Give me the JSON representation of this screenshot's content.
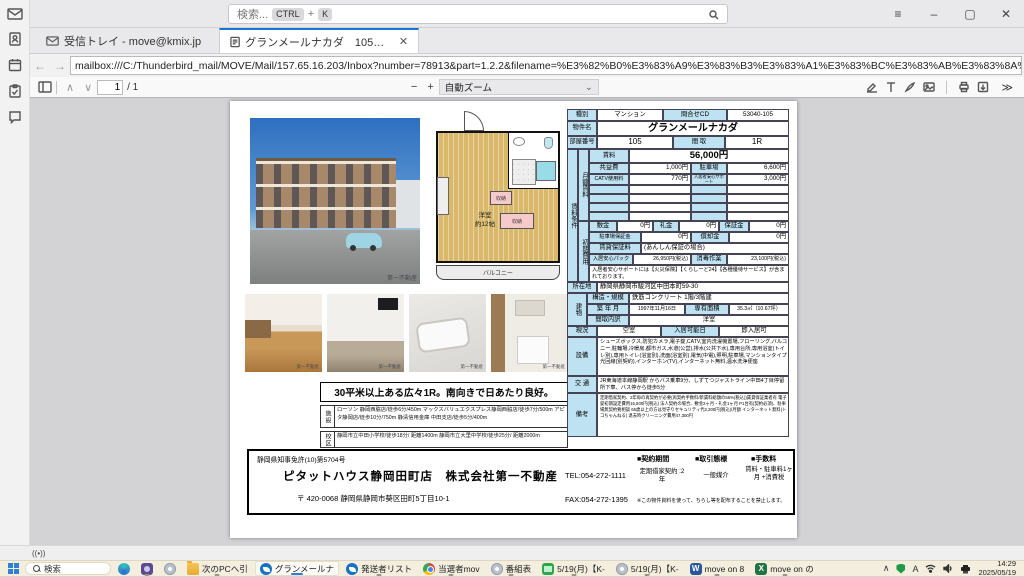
{
  "colors": {
    "accent_blue": "#1a73d1",
    "table_label_blue": "#bfe2f2",
    "taskbar_bg": "#f3eedd"
  },
  "titlebar": {
    "search_placeholder": "検索...",
    "key_ctrl": "CTRL",
    "key_plus": "+",
    "key_k": "K"
  },
  "window_controls": {
    "menu": "≡",
    "minimize": "–",
    "maximize": "▢",
    "close": "✕"
  },
  "tabs": {
    "inbox": "受信トレイ - move@kmix.jp",
    "pdf": "グランメールナカダ　105号室.p",
    "pdf_close": "✕"
  },
  "urlbar": {
    "back": "←",
    "forward": "→",
    "url": "mailbox:///C:/Thunderbird_mail/MOVE/Mail/157.65.16.203/Inbox?number=78913&part=1.2.2&filename=%E3%82%B0%E3%83%A9%E3%83%B3%E3%83%A1%E3%83%BC%E3%83%AB%E3%83%8A%E3%82%AB%E3%83%80%E3%80%80105%E"
  },
  "pdfbar": {
    "up": "∧",
    "down": "∨",
    "page": "1",
    "total": "/ 1",
    "minus": "−",
    "plus": "+",
    "zoom": "自動ズーム",
    "zoom_caret": "⌄",
    "more": "≫"
  },
  "statusbar": {
    "broadcast": "((•))"
  },
  "doc": {
    "spec": {
      "type_label": "種別",
      "type": "マンション",
      "code_label": "問合せCD",
      "code": "53040-105",
      "name_label": "物件名",
      "name": "グランメールナカダ",
      "room_label": "部屋番号",
      "room": "105",
      "layout_label": "間 取",
      "layout": "1R"
    },
    "terms_label": "賃料条件",
    "monthly_label": "月額賃料",
    "monthly": {
      "rent_label": "賃料",
      "rent": "56,000円",
      "fee_label": "共益費",
      "fee": "1,000円",
      "parking_label": "駐車場",
      "parking": "6,600円",
      "catv_label": "CATV使用料",
      "catv": "770円",
      "support_label": "入居者安心サポート",
      "support": "3,000円"
    },
    "initial_label": "初期費用",
    "initial": {
      "shikikin_label": "敷金",
      "shikikin": "0円",
      "reikin_label": "礼金",
      "reikin": "0円",
      "hoshokin_label": "保証金",
      "hoshokin": "0円",
      "parking_dep_label": "駐車場保証金",
      "parking_dep": "0円",
      "shokyaku_label": "償却金",
      "shokyaku": "0円",
      "guarantee_label": "賃貸保証料",
      "guarantee": "(あんしん保証の場合)",
      "anshin_label": "入居安心パック",
      "anshin": "26,950円(税込)",
      "disinfect_label": "消毒作業",
      "disinfect": "23,100円(税込)",
      "note": "入居者安心サポートには【火災保険】【くらしーど24】【各種優待サービス】が含まれております。"
    },
    "location_label": "所在地",
    "location": "静岡県静岡市駿河区中田本町59-30",
    "building_label": "建物",
    "building": {
      "structure_label": "構造・規模",
      "structure": "鉄筋コンクリート 1階/3階建",
      "built_label": "築 年 月",
      "built": "1997年11月16日",
      "area_label": "専有面積",
      "area": "35.3㎡（10.67坪）",
      "layout_detail_label": "間取内訳",
      "layout_detail": "洋室"
    },
    "status_label": "現況",
    "status": "空室",
    "movein_label": "入居可能日",
    "movein": "即入居可",
    "equipment_label": "設備",
    "equipment": "シューズボックス,防犯カメラ,電子錠,CATV,室内洗濯機置場,フローリング,バルコニー,駐輪場,冷暖房,都市ガス,水道(公営),排水(公共下水),専用台所,専用浴室(トイレ別),専用トイレ(浴室別),洗面(浴室別),電気(中電),照明,駐車場,マンションタイプ光回線(別契約),インターホン(TV),インターネット無料,温水洗浄便座",
    "access_label": "交 通",
    "access": "JR東海道本線静岡駅 からバス乗車9分、しずてつジャストライン中田4丁目停留所下車、バス停から徒歩5分",
    "remarks_label": "備考",
    "remarks": "定期借家契約、2年毎の再契約が必要(再契約手数料/新賃料総額の55%(税込))賃貸保証業者有 電子錠初期設定費用16,500円(税込) 法人契約の場合、敷金2ヶ月・礼金1ヶ月 P1台有(契約必須)、駐車場無契約要相談 65歳以上の方は見守りセキュリティ代2,200円(税込)/月額 インターネット無料(トコちゃんねる) 退去時クリーニング費用47,300円",
    "headline": "30平米以上ある広々1R。南向きで日あたり良好。",
    "facility_label": "施設",
    "facility": "ローソン 静岡西脇店/徒歩6分/450m マックスバリュエクスプレス静岡西脇店/徒歩7分/500m アピタ静岡店/徒歩10分/750m 静清信用金庫 中田支店/徒歩5分/400m",
    "school_label": "校区",
    "school": "静岡市立中田小学校/徒歩18分/ 距離1400m 静岡市立大里中学校/徒歩25分/ 距離2000m",
    "plan": {
      "room": "洋室",
      "size": "約12帖",
      "balcony": "バルコニー",
      "storage1": "収納",
      "storage2": "収納"
    },
    "photo_watermark": "第一不動産",
    "footer": {
      "license": "静岡県知事免許(10)第5704号",
      "company": "ピタットハウス静岡田町店　株式会社第一不動産",
      "address": "〒 420-0068 静岡県静岡市葵区田町5丁目10-1",
      "tel": "TEL:054-272-1111",
      "fax": "FAX:054-272-1395",
      "contract_h": "■契約期間",
      "deal_h": "■取引態様",
      "fee_h": "■手数料",
      "contract": "定期借家契約 :2年",
      "deal": "一般媒介",
      "fee": "賃料・駐車料1ヶ月 +消費税",
      "note": "※この物件資料を使って、ちらし等を配布することを禁止します。"
    }
  },
  "taskbar": {
    "search": "検索",
    "items": [
      {
        "label": "次のPCへ引"
      },
      {
        "label": "グランメールナ"
      },
      {
        "label": "発送者リスト"
      },
      {
        "label": "当選者mov"
      },
      {
        "label": "番組表"
      },
      {
        "label": "5/19(月)【K-"
      },
      {
        "label": "5/19(月)【K-"
      },
      {
        "label": "move on 8"
      },
      {
        "label": "move on の"
      }
    ],
    "word_letter": "W",
    "excel_letter": "X",
    "tray_chevron": "∧",
    "ime": "A",
    "clock_time": "14:29",
    "clock_date": "2025/05/19"
  }
}
